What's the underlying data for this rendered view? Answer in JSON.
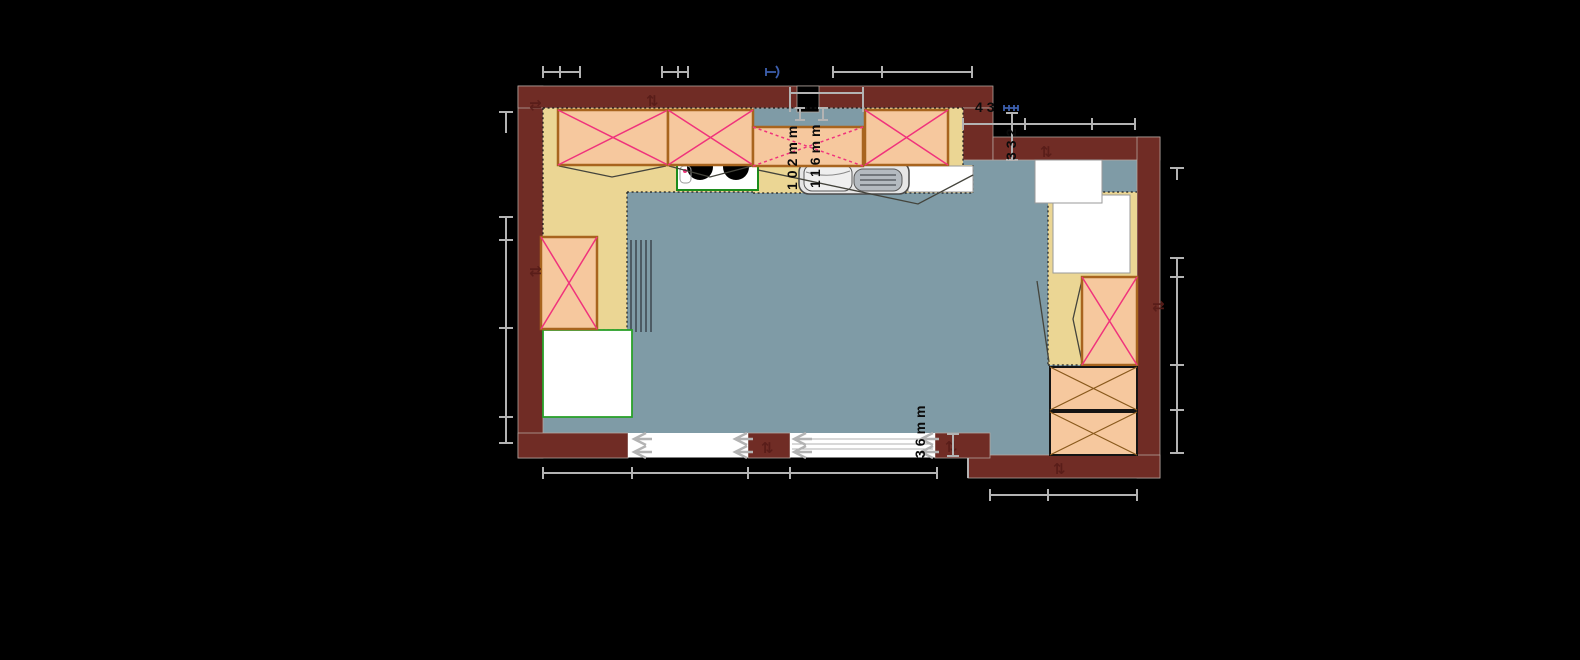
{
  "app": {
    "type": "kitchen-planner-floor-plan-view",
    "background": "#000000"
  },
  "palette": {
    "wall": "#702c25",
    "floor": "#7f9ba6",
    "countertop": "#ebd694",
    "cabinet_fill": "#f6c89e",
    "cabinet_border": "#a8641e",
    "wall_cabinet_cross": "#f0337c",
    "tall_unit_cross": "#8a5a1d",
    "dimension_line": "#b3b3b3",
    "dimension_accent_blue": "#3d5fae",
    "appliance_white": "#ffffff",
    "appliance_green_border": "#2aa12a",
    "sink_drainer_gray": "#b4bac0"
  },
  "dimensions": {
    "niche_left_label": "102mm",
    "niche_right_label": "116mm",
    "top_right_width_label": "43",
    "top_right_height_label": "332",
    "door_gap_label": "36mm"
  },
  "icons": {
    "sliding_door_arrow": "double-chevron-left",
    "wall_opening_marker": "up-down-arrows",
    "burner": "black-circle",
    "cabinet_cross": "x-cross"
  }
}
